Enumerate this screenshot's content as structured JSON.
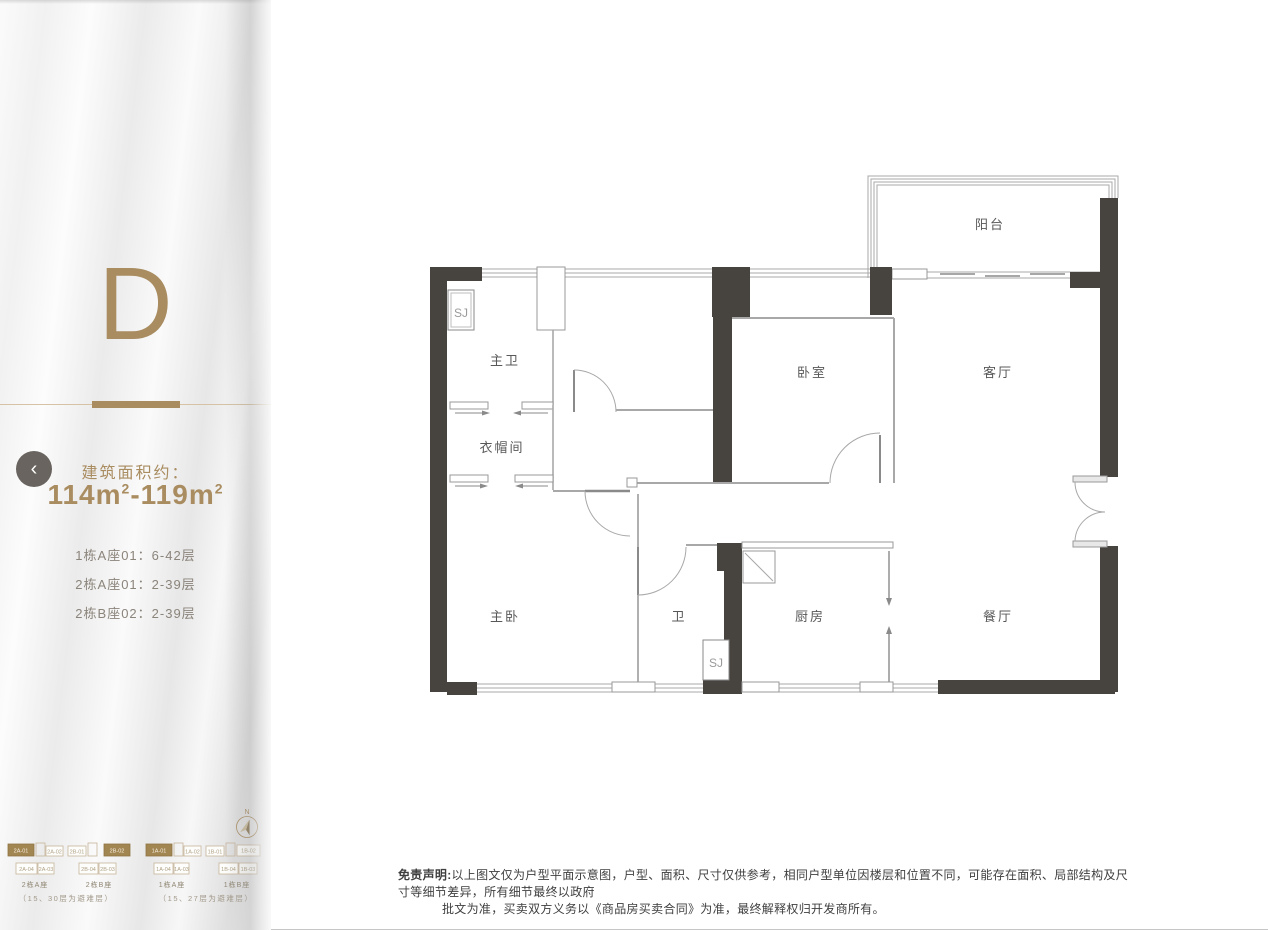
{
  "sidebar": {
    "unit_letter": "D",
    "back_glyph": "‹",
    "area_label": "建筑面积约：",
    "area_value": "114m²-119m²",
    "floors": [
      "1栋A座01：6-42层",
      "2栋A座01：2-39层",
      "2栋B座02：2-39层"
    ]
  },
  "mini_map": {
    "compass_label": "N",
    "buildings": [
      {
        "name_a": "2栋A座",
        "name_b": "2栋B座",
        "note": "（15、30层为避难层）",
        "top_units": [
          {
            "id": "2A-01",
            "highlight": true
          },
          {
            "id": "2A-02",
            "highlight": false
          },
          {
            "id": "2B-01",
            "highlight": false
          },
          {
            "id": "2B-02",
            "highlight": true
          }
        ],
        "bottom_units": [
          "2A-04",
          "2A-03",
          "2B-04",
          "2B-03"
        ]
      },
      {
        "name_a": "1栋A座",
        "name_b": "1栋B座",
        "note": "（15、27层为避难层）",
        "top_units": [
          {
            "id": "1A-01",
            "highlight": true
          },
          {
            "id": "1A-02",
            "highlight": false
          },
          {
            "id": "1B-01",
            "highlight": false
          },
          {
            "id": "1B-02",
            "highlight": false
          }
        ],
        "bottom_units": [
          "1A-04",
          "1A-03",
          "1B-04",
          "1B-03"
        ]
      }
    ]
  },
  "floor_plan": {
    "rooms": [
      "阳台",
      "主卫",
      "衣帽间",
      "卧室",
      "客厅",
      "主卧",
      "卫",
      "厨房",
      "餐厅"
    ],
    "shafts": [
      "SJ",
      "SJ"
    ]
  },
  "disclaimer": {
    "prefix": "免责声明:",
    "line1": "以上图文仅为户型平面示意图，户型、面积、尺寸仅供参考，相同户型单位因楼层和位置不同，可能存在面积、局部结构及尺寸等细节差异，所有细节最终以政府",
    "line2": "批文为准，买卖双方义务以《商品房买卖合同》为准，最终解释权归开发商所有。"
  },
  "colors": {
    "accent_gold": "#a98c60",
    "wall_dark": "#474440",
    "unit_highlight": "#a28652"
  }
}
